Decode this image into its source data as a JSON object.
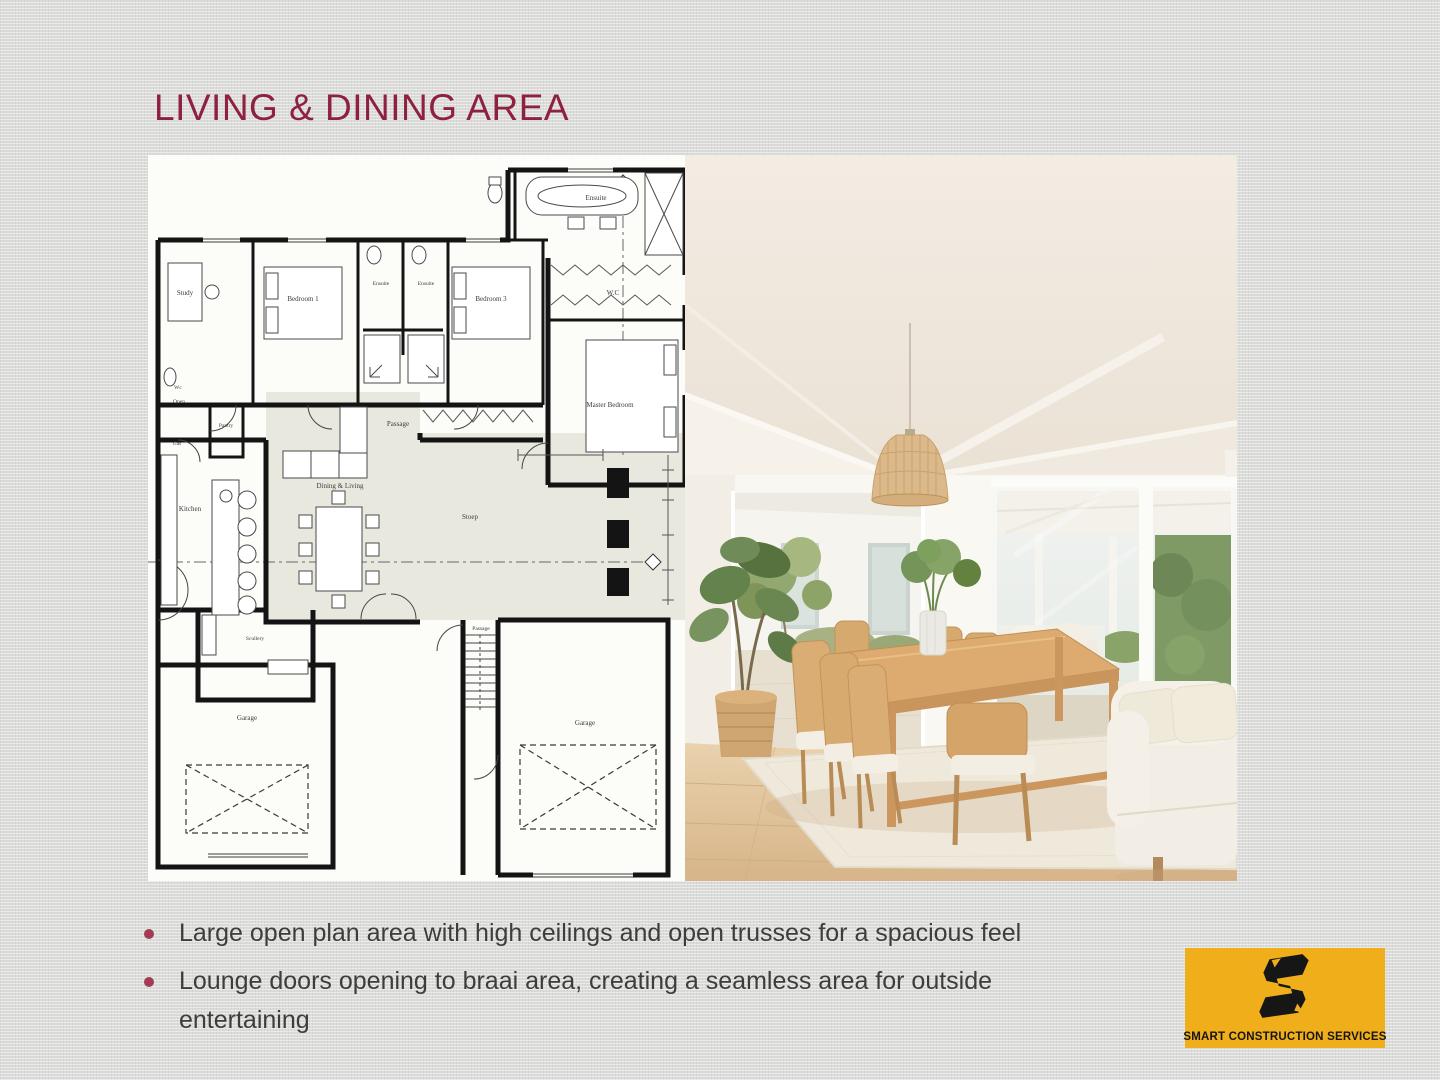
{
  "slide": {
    "title": "LIVING & DINING AREA",
    "bullets": [
      "Large open plan area with high ceilings  and open trusses for a spacious feel",
      "Lounge doors opening to braai area, creating a seamless area for outside entertaining"
    ]
  },
  "floor_plan": {
    "rooms": [
      {
        "name": "Study"
      },
      {
        "name": "Bedroom 1"
      },
      {
        "name": "Ensuite"
      },
      {
        "name": "Ensuite"
      },
      {
        "name": "Bedroom 3"
      },
      {
        "name": "Ensuite"
      },
      {
        "name": "W.C"
      },
      {
        "name": "Master Bedroom"
      },
      {
        "name": "Passage"
      },
      {
        "name": "Wc"
      },
      {
        "name": "Open"
      },
      {
        "name": "Gas"
      },
      {
        "name": "Pantry"
      },
      {
        "name": "Kitchen"
      },
      {
        "name": "Scullery"
      },
      {
        "name": "Dining & Living"
      },
      {
        "name": "Stoep"
      },
      {
        "name": "Garage"
      },
      {
        "name": "Passage"
      },
      {
        "name": "Garage"
      }
    ]
  },
  "photo": {
    "description": "Dining room with white vaulted ceiling, rattan pendant light, oak dining table with eight woven chairs on a cream rug, potted plant, sliding glass doors to patio and a white sofa"
  },
  "logo": {
    "name": "SMART CONSTRUCTION SERVICES",
    "background": "#EFAE1A"
  },
  "colors": {
    "slide_background": "#DCDCDA",
    "title": "#8E2140",
    "bullet_dot": "#A43B54",
    "body_text": "#3D3D3D"
  }
}
